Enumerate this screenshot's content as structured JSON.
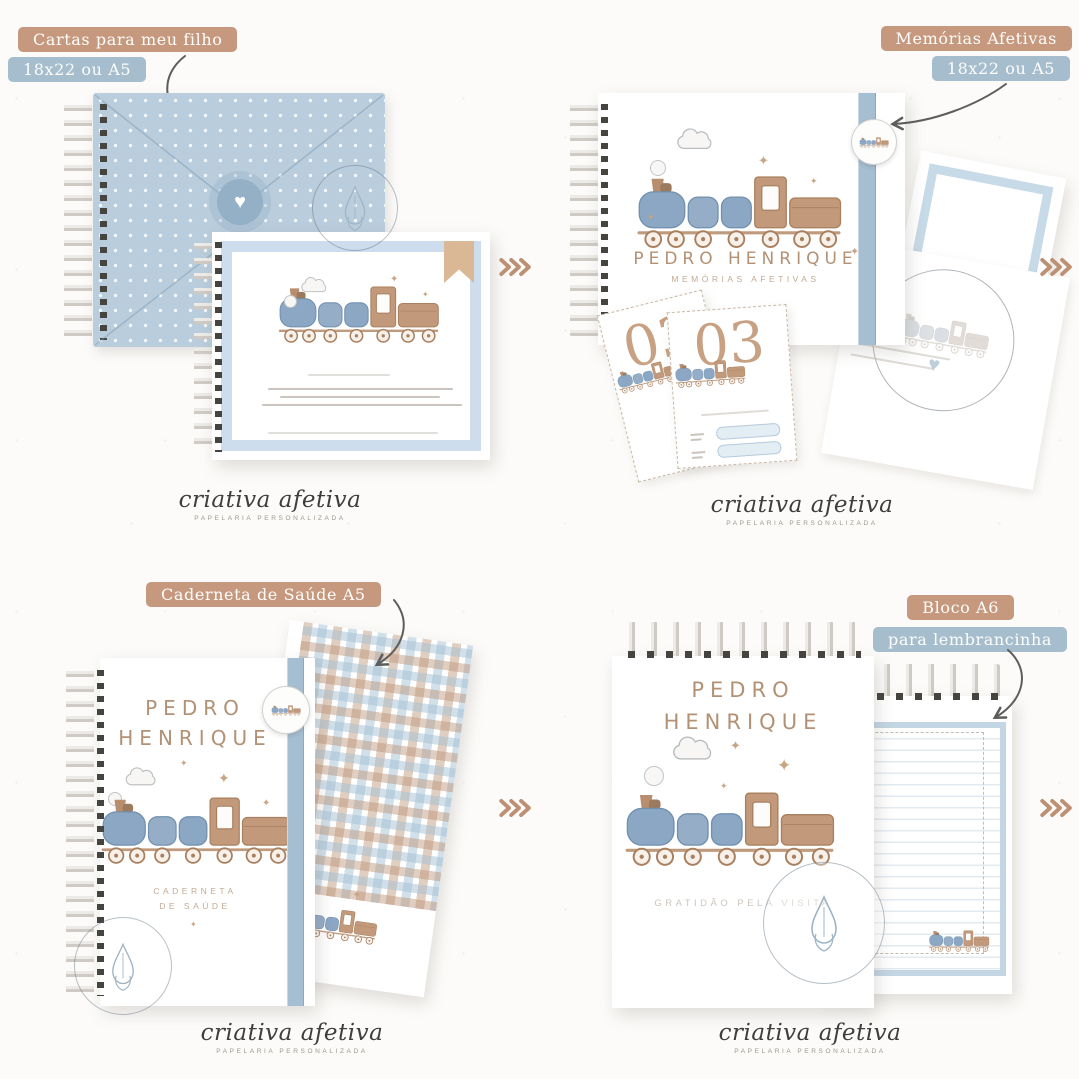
{
  "brand": {
    "logo": "criativa afetiva",
    "tagline": "PAPELARIA PERSONALIZADA"
  },
  "icons": {
    "heart": "♥",
    "star": "✦"
  },
  "colors": {
    "badge_tan": "#c6997e",
    "badge_blue": "#a5bdcc",
    "envelope_blue": "#b9cddd",
    "ribbon_blue": "#a6bed1",
    "frame_blue": "#cddded",
    "train_blue": "#8ba7c4",
    "train_brown": "#c29a7b",
    "name_brown": "#b39174",
    "milestone_tan": "#c8a183",
    "chevron_tan": "#bd9073",
    "logo_gray": "#3e3e3e"
  },
  "quadrants": {
    "letters": {
      "badge_title": "Cartas para meu filho",
      "badge_size": "18x22 ou A5"
    },
    "memories": {
      "badge_title": "Memórias Afetivas",
      "badge_size": "18x22 ou A5",
      "cover_name": "PEDRO HENRIQUE",
      "cover_subtitle": "MEMÓRIAS AFETIVAS",
      "milestone_number": "03"
    },
    "health": {
      "badge_title": "Caderneta de Saúde A5",
      "name_line1": "PEDRO",
      "name_line2": "HENRIQUE",
      "subtitle_line1": "CADERNETA",
      "subtitle_line2": "DE SAÚDE"
    },
    "keepsake": {
      "badge_title": "Bloco A6",
      "badge_subtitle": "para lembrancinha",
      "name_line1": "PEDRO",
      "name_line2": "HENRIQUE",
      "footer": "GRATIDÃO PELA VISITA"
    }
  }
}
